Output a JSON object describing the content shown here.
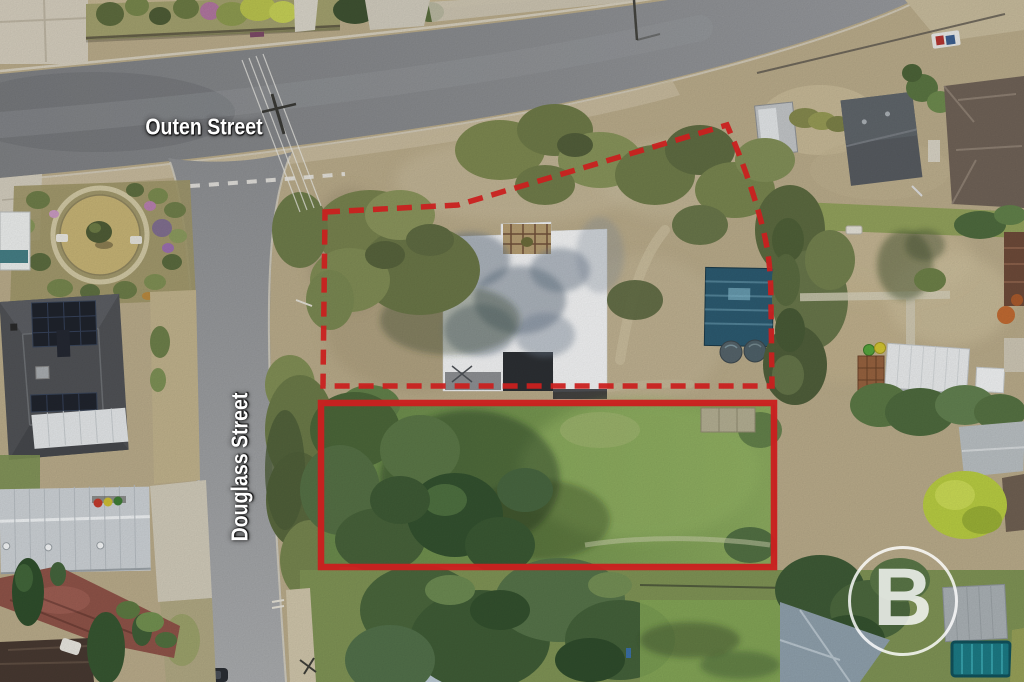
{
  "photo": {
    "description": "Aerial drone photograph of residential allotments with red lot outlines",
    "streets": {
      "horizontal": "Outen Street",
      "vertical": "Douglass Street"
    },
    "watermark_letter": "B",
    "boundary": {
      "color": "#c9201f",
      "upper_lot_style": "dashed",
      "lower_lot_style": "solid"
    }
  }
}
